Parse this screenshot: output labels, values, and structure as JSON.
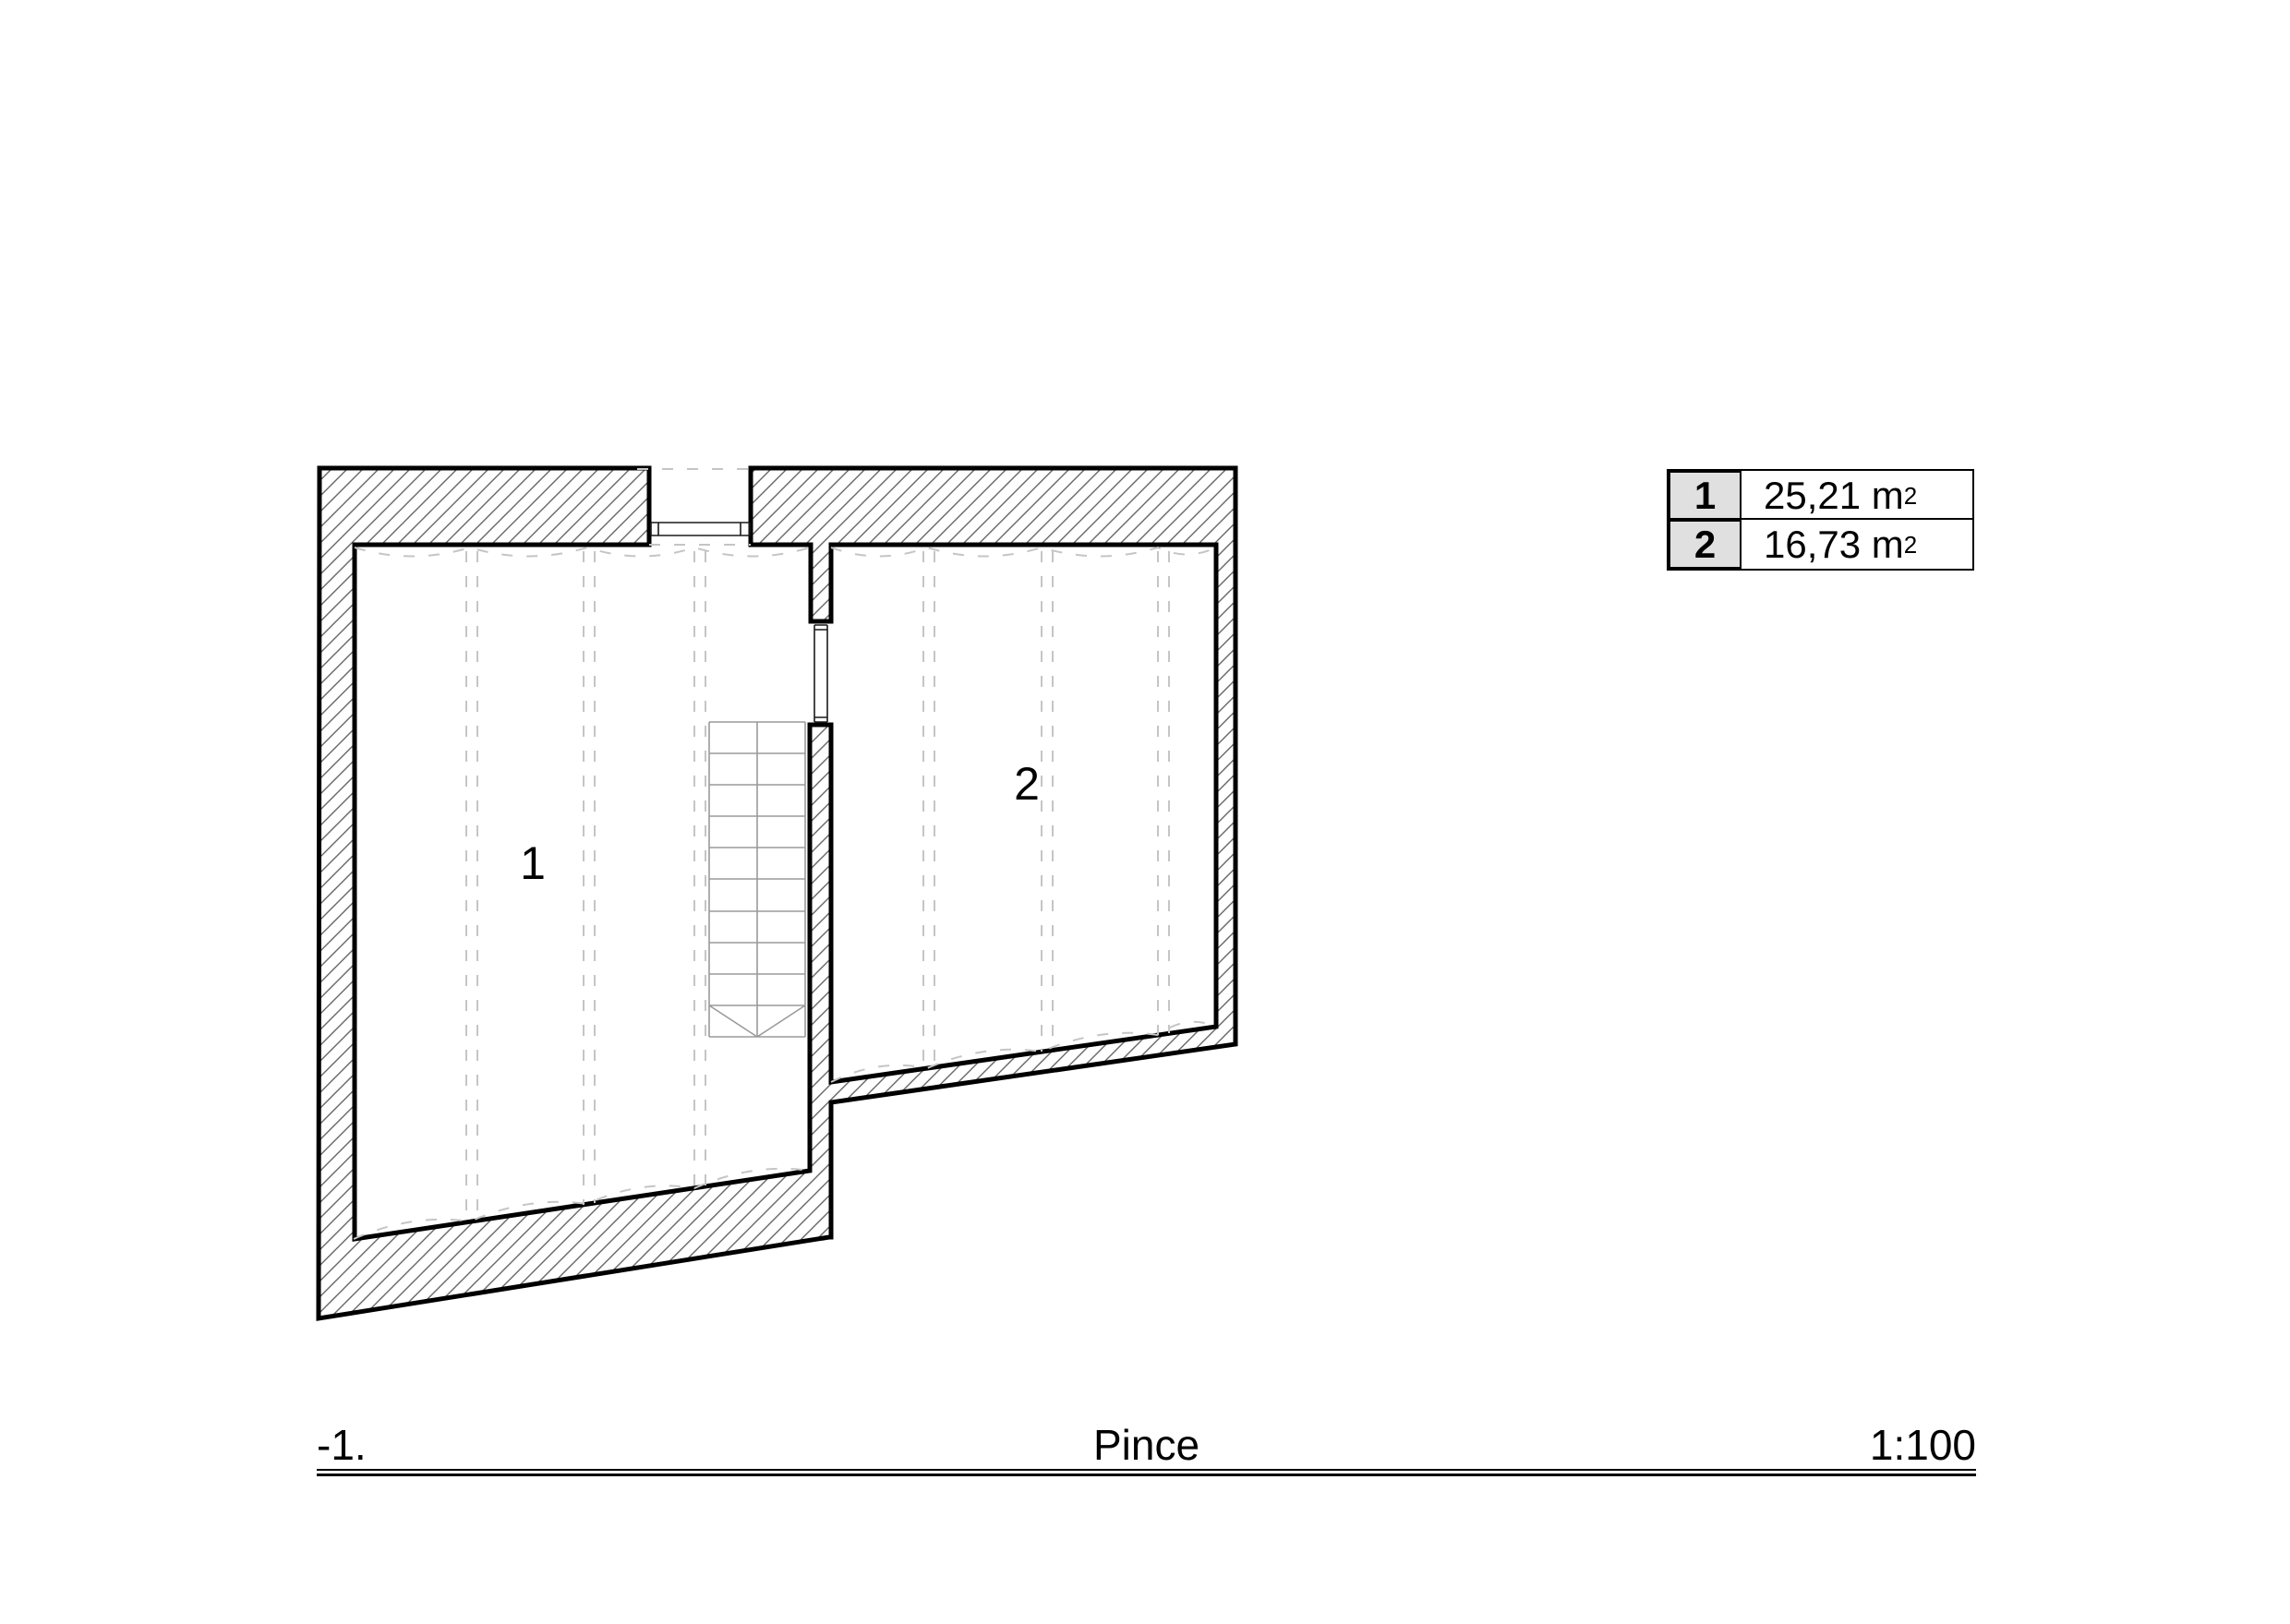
{
  "plan": {
    "room_labels": [
      {
        "text": "1"
      },
      {
        "text": "2"
      }
    ],
    "elements": {
      "walls": "hatched-masonry-walls",
      "stair": "stair-run-10-treads",
      "window_opening": "top-wall-opening",
      "door_opening": "partition-door-opening"
    }
  },
  "legend": {
    "rows": [
      {
        "number": "1",
        "area": "25,21 m",
        "sup": "2"
      },
      {
        "number": "2",
        "area": "16,73 m",
        "sup": "2"
      }
    ]
  },
  "title_bar": {
    "level": "-1.",
    "name": "Pince",
    "scale": "1:100"
  },
  "colors": {
    "line": "#000000",
    "hatch": "#666666",
    "stair": "#9a9a9a",
    "guide_dashed": "#c5c5c5",
    "legend_cell_bg": "#e0e0e0",
    "background": "#ffffff"
  }
}
